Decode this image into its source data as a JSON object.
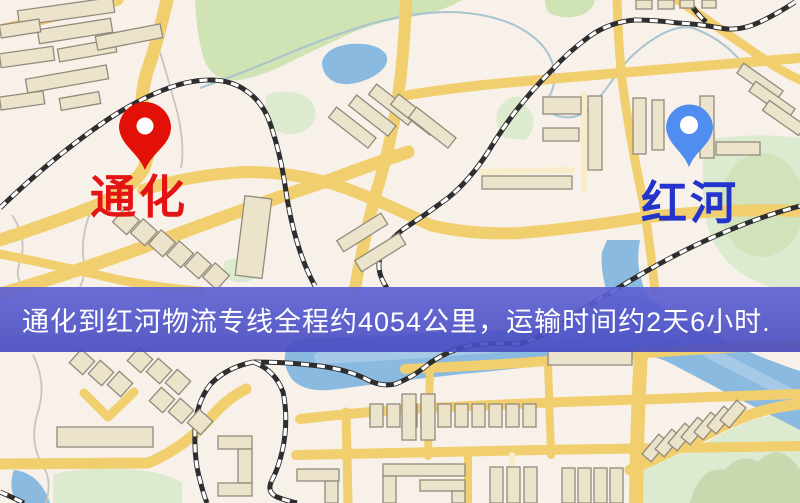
{
  "banner": {
    "text": "通化到红河物流专线全程约4054公里，运输时间约2天6小时.",
    "background": "#4d50c6",
    "text_color": "#ffffff"
  },
  "route": {
    "origin": "通化",
    "destination": "红河",
    "distance": "约4054公里",
    "duration": "约2天6小时"
  },
  "markers": {
    "origin": {
      "label": "通化",
      "pin_color": "#e31007",
      "label_color": "#e41414"
    },
    "destination": {
      "label": "红河",
      "pin_color": "#4f8df0",
      "label_color": "#2333cc"
    }
  },
  "map": {
    "colors": {
      "background": "#f7f1ea",
      "road": "#f2cf6e",
      "water": "#8abadf",
      "park": "#cfe3b4",
      "building": "#ece3cb",
      "railway": "#2e2e2e"
    }
  }
}
